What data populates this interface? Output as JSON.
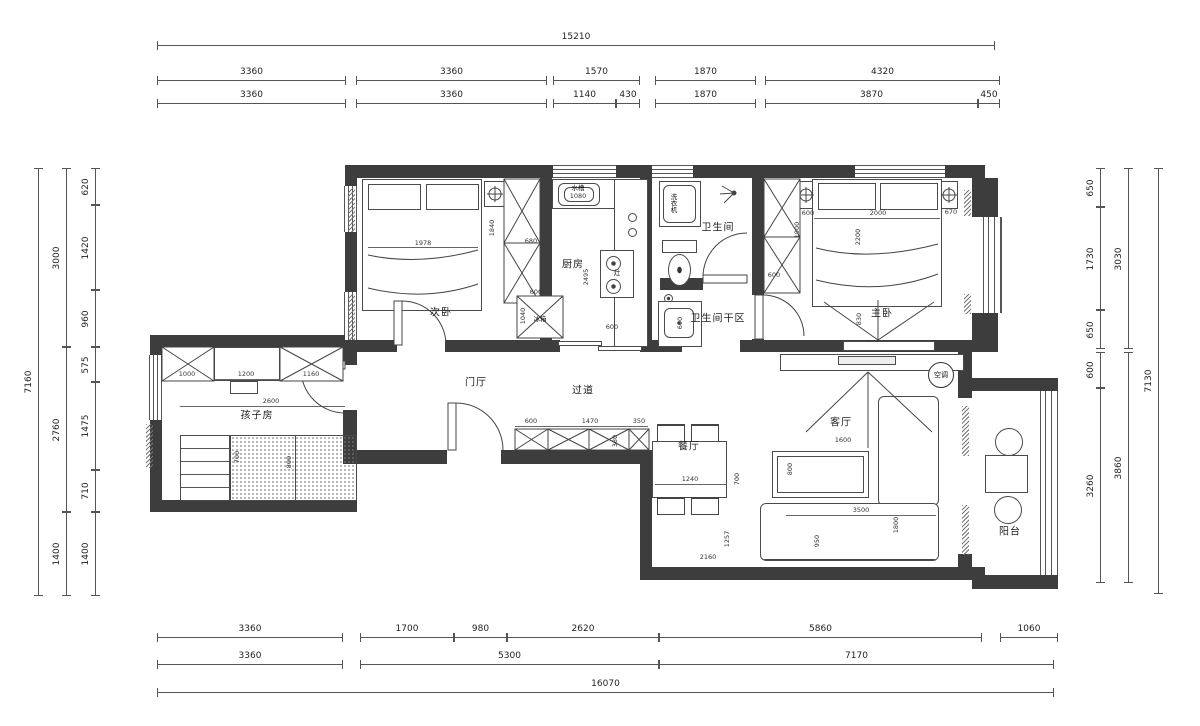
{
  "plan": {
    "rooms": [
      {
        "label": "次卧",
        "x": 441,
        "y": 311
      },
      {
        "label": "厨房",
        "x": 573,
        "y": 263
      },
      {
        "label": "卫生间",
        "x": 718,
        "y": 226
      },
      {
        "label": "卫生间干区",
        "x": 718,
        "y": 317
      },
      {
        "label": "主卧",
        "x": 882,
        "y": 312
      },
      {
        "label": "孩子房",
        "x": 257,
        "y": 414
      },
      {
        "label": "门厅",
        "x": 476,
        "y": 381
      },
      {
        "label": "过道",
        "x": 583,
        "y": 389
      },
      {
        "label": "餐厅",
        "x": 689,
        "y": 445
      },
      {
        "label": "客厅",
        "x": 841,
        "y": 421
      },
      {
        "label": "阳台",
        "x": 1010,
        "y": 530
      }
    ],
    "appliances": [
      {
        "label": "水槽",
        "x": 578,
        "y": 187,
        "vert": false
      },
      {
        "label": "洗衣机",
        "x": 673,
        "y": 203,
        "vert": true
      },
      {
        "label": "冰箱",
        "x": 540,
        "y": 318,
        "vert": false
      },
      {
        "label": "灶",
        "x": 617,
        "y": 272,
        "vert": false
      }
    ],
    "hvac": {
      "label": "空调",
      "x": 941,
      "y": 375
    },
    "inner_dims": [
      {
        "t": "1978",
        "x": 423,
        "y": 243
      },
      {
        "t": "1840",
        "x": 492,
        "y": 228,
        "v": 1
      },
      {
        "t": "680",
        "x": 531,
        "y": 241
      },
      {
        "t": "600",
        "x": 536,
        "y": 292
      },
      {
        "t": "1040",
        "x": 523,
        "y": 316,
        "v": 1
      },
      {
        "t": "2495",
        "x": 586,
        "y": 277,
        "v": 1
      },
      {
        "t": "1080",
        "x": 578,
        "y": 196
      },
      {
        "t": "600",
        "x": 612,
        "y": 327
      },
      {
        "t": "600",
        "x": 680,
        "y": 323,
        "v": 1
      },
      {
        "t": "1900",
        "x": 797,
        "y": 230,
        "v": 1
      },
      {
        "t": "600",
        "x": 808,
        "y": 213
      },
      {
        "t": "2000",
        "x": 878,
        "y": 213
      },
      {
        "t": "670",
        "x": 951,
        "y": 212
      },
      {
        "t": "2200",
        "x": 858,
        "y": 237,
        "v": 1
      },
      {
        "t": "600",
        "x": 774,
        "y": 275
      },
      {
        "t": "830",
        "x": 859,
        "y": 319,
        "v": 1
      },
      {
        "t": "1000",
        "x": 187,
        "y": 374
      },
      {
        "t": "1200",
        "x": 246,
        "y": 374
      },
      {
        "t": "1160",
        "x": 311,
        "y": 374
      },
      {
        "t": "2600",
        "x": 271,
        "y": 401
      },
      {
        "t": "700",
        "x": 237,
        "y": 457,
        "v": 1
      },
      {
        "t": "800",
        "x": 289,
        "y": 462,
        "v": 1
      },
      {
        "t": "600",
        "x": 531,
        "y": 421
      },
      {
        "t": "1470",
        "x": 590,
        "y": 421
      },
      {
        "t": "350",
        "x": 639,
        "y": 421
      },
      {
        "t": "380",
        "x": 615,
        "y": 441,
        "v": 1
      },
      {
        "t": "1240",
        "x": 690,
        "y": 479
      },
      {
        "t": "700",
        "x": 737,
        "y": 479,
        "v": 1
      },
      {
        "t": "1257",
        "x": 727,
        "y": 539,
        "v": 1
      },
      {
        "t": "2160",
        "x": 708,
        "y": 557
      },
      {
        "t": "1600",
        "x": 843,
        "y": 440
      },
      {
        "t": "800",
        "x": 790,
        "y": 469,
        "v": 1
      },
      {
        "t": "3500",
        "x": 861,
        "y": 510
      },
      {
        "t": "950",
        "x": 817,
        "y": 541,
        "v": 1
      },
      {
        "t": "1800",
        "x": 896,
        "y": 525,
        "v": 1
      }
    ],
    "dim_rows": [
      {
        "o": "h",
        "pos": 45,
        "segs": [
          [
            "15210",
            157,
            995
          ]
        ]
      },
      {
        "o": "h",
        "pos": 80,
        "segs": [
          [
            "3360",
            157,
            346
          ],
          [
            "3360",
            356,
            547
          ],
          [
            "1570",
            553,
            640
          ],
          [
            "1870",
            655,
            756
          ],
          [
            "4320",
            765,
            1000
          ]
        ]
      },
      {
        "o": "h",
        "pos": 103,
        "segs": [
          [
            "3360",
            157,
            346
          ],
          [
            "3360",
            356,
            547
          ],
          [
            "1140",
            553,
            616
          ],
          [
            "430",
            616,
            640
          ],
          [
            "1870",
            655,
            756
          ],
          [
            "3870",
            765,
            978
          ],
          [
            "450",
            978,
            1000
          ]
        ]
      },
      {
        "o": "h",
        "pos": 637,
        "segs": [
          [
            "3360",
            157,
            343
          ],
          [
            "1700",
            360,
            454
          ],
          [
            "980",
            454,
            507
          ],
          [
            "2620",
            507,
            659
          ],
          [
            "5860",
            659,
            982
          ],
          [
            "1060",
            1000,
            1058
          ]
        ]
      },
      {
        "o": "h",
        "pos": 664,
        "segs": [
          [
            "3360",
            157,
            343
          ],
          [
            "5300",
            360,
            659
          ],
          [
            "7170",
            659,
            1054
          ]
        ]
      },
      {
        "o": "h",
        "pos": 692,
        "segs": [
          [
            "16070",
            157,
            1054
          ]
        ]
      },
      {
        "o": "v",
        "pos": 95,
        "segs": [
          [
            "620",
            168,
            205
          ],
          [
            "1420",
            205,
            290
          ],
          [
            "960",
            290,
            347
          ],
          [
            "575",
            347,
            382
          ],
          [
            "1475",
            382,
            470
          ],
          [
            "710",
            470,
            512
          ],
          [
            "1400",
            512,
            596
          ]
        ]
      },
      {
        "o": "v",
        "pos": 66,
        "segs": [
          [
            "3000",
            168,
            347
          ],
          [
            "2760",
            347,
            512
          ],
          [
            "1400",
            512,
            596
          ]
        ]
      },
      {
        "o": "v",
        "pos": 38,
        "segs": [
          [
            "7160",
            168,
            596
          ]
        ]
      },
      {
        "o": "v",
        "pos": 1100,
        "segs": [
          [
            "650",
            168,
            207
          ],
          [
            "1730",
            207,
            310
          ],
          [
            "650",
            310,
            349
          ],
          [
            "600",
            352,
            388
          ],
          [
            "3260",
            388,
            583
          ]
        ]
      },
      {
        "o": "v",
        "pos": 1128,
        "segs": [
          [
            "3030",
            168,
            349
          ],
          [
            "3860",
            352,
            583
          ]
        ]
      },
      {
        "o": "v",
        "pos": 1158,
        "segs": [
          [
            "7130",
            168,
            594
          ]
        ]
      }
    ]
  }
}
